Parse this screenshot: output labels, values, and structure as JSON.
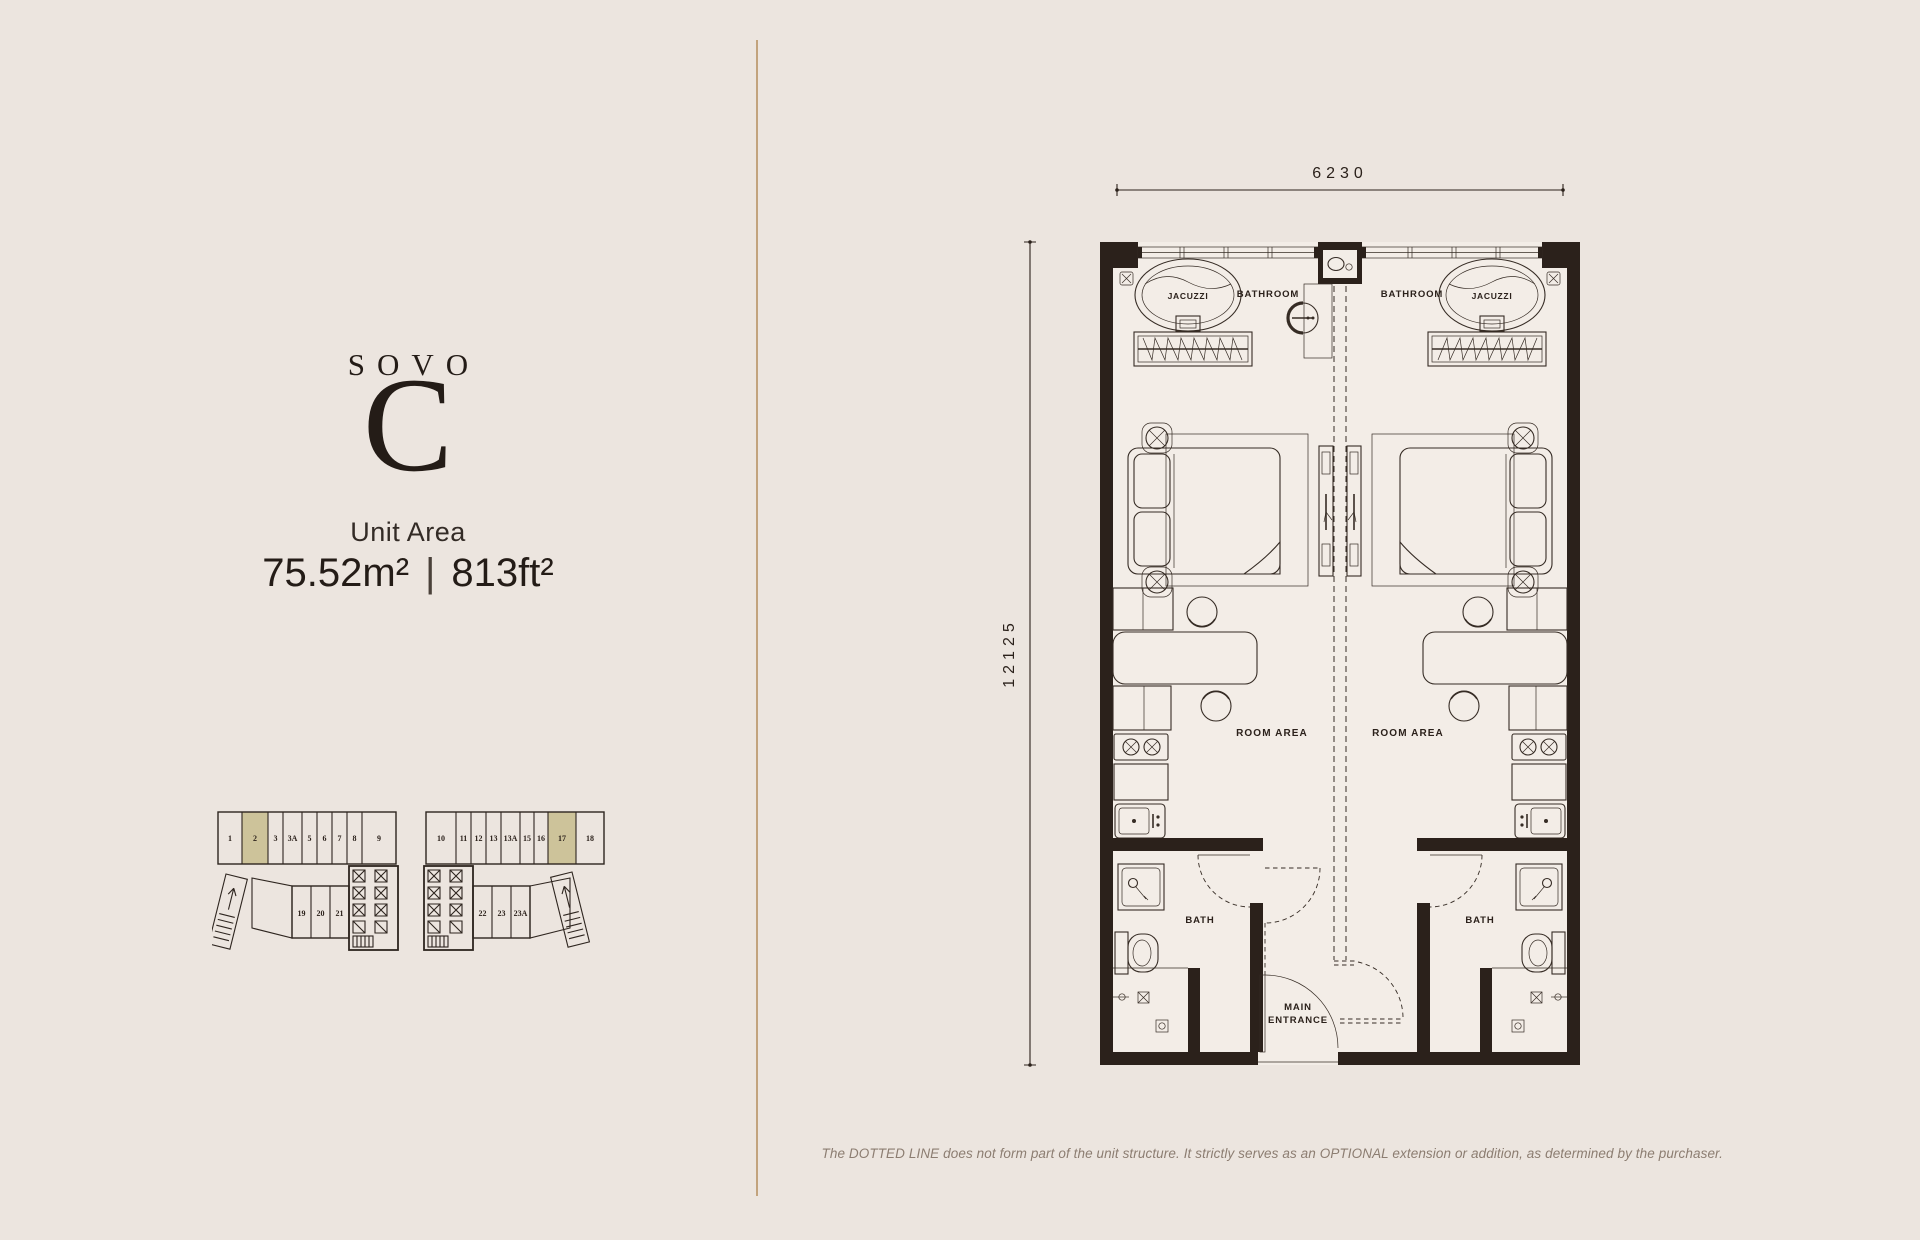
{
  "page": {
    "background_color": "#ece5df",
    "divider_color": "#c2a37d",
    "ink_color": "#2b211b"
  },
  "left_panel": {
    "brand": "SOVO",
    "unit_letter": "C",
    "unit_area_label": "Unit Area",
    "area_metric": "75.52m²",
    "area_separator": "|",
    "area_imperial": "813ft²"
  },
  "floor_plan": {
    "dimension_width": "6230",
    "dimension_height": "12125",
    "labels": {
      "bathroom_left": "BATHROOM",
      "bathroom_right": "BATHROOM",
      "jacuzzi_left": "JACUZZI",
      "jacuzzi_right": "JACUZZI",
      "room_area_left": "ROOM AREA",
      "room_area_right": "ROOM AREA",
      "bath_left": "BATH",
      "bath_right": "BATH",
      "main_entrance_line1": "MAIN",
      "main_entrance_line2": "ENTRANCE"
    }
  },
  "key_plan": {
    "highlight_color": "#cdc39a",
    "left_block": {
      "top_units": [
        "1",
        "2",
        "3",
        "3A",
        "5",
        "6",
        "7",
        "8",
        "9"
      ],
      "highlighted_unit": "2",
      "lower_units": [
        "19",
        "20",
        "21"
      ]
    },
    "right_block": {
      "top_units": [
        "10",
        "11",
        "12",
        "13",
        "13A",
        "15",
        "16",
        "17",
        "18"
      ],
      "highlighted_unit": "17",
      "lower_units": [
        "22",
        "23",
        "23A"
      ]
    }
  },
  "disclaimer": "The DOTTED LINE does not form part of the unit structure. It strictly serves as an OPTIONAL extension or addition, as determined by the purchaser."
}
